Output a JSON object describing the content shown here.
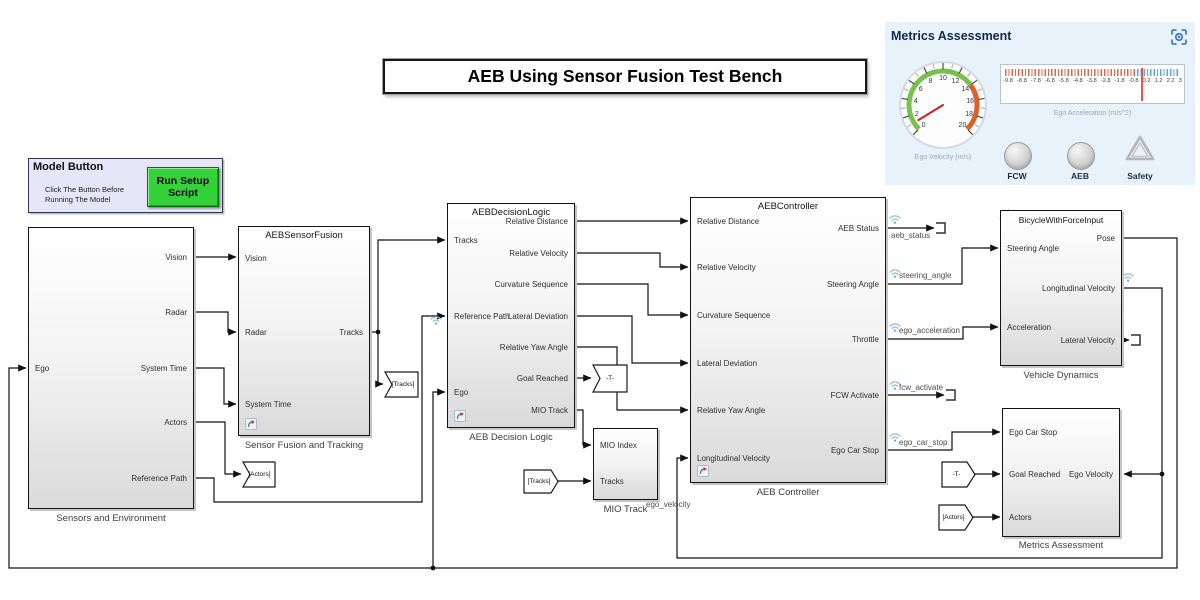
{
  "title": "AEB Using Sensor Fusion Test Bench",
  "model_button": {
    "title": "Model Button",
    "description_line1": "Click The Button Before",
    "description_line2": "Running The Model",
    "button_label": "Run Setup Script",
    "button_color": "#35d13a"
  },
  "metrics_panel": {
    "title": "Metrics Assessment",
    "expand_icon": "viewfinder-gear-icon",
    "velocity_gauge": {
      "label": "Ego Velocity (m/s)",
      "min": 0,
      "max": 20,
      "tick_labels": [
        "0",
        "2",
        "4",
        "6",
        "8",
        "10",
        "12",
        "14",
        "16",
        "18",
        "20"
      ],
      "green_range": [
        0,
        14
      ],
      "red_range": [
        14,
        20
      ],
      "needle_value": 1,
      "green_color": "#77c14d",
      "red_color": "#d9622c",
      "needle_color": "#cf201f"
    },
    "accel_gauge": {
      "label": "Ego Acceleration (m/s^2)",
      "tick_labels": [
        "-9.8",
        "-8.8",
        "-7.8",
        "-6.8",
        "-5.8",
        "-4.8",
        "-3.8",
        "-2.8",
        "-1.8",
        "-0.8",
        "0.2",
        "1.2",
        "2.2",
        "3"
      ],
      "needle_value": 0.2,
      "red_color": "#dd674d",
      "blue_color": "#56a8dd",
      "needle_color": "#f25050"
    },
    "lamps": [
      {
        "label": "FCW"
      },
      {
        "label": "AEB"
      }
    ],
    "safety": {
      "label": "Safety"
    }
  },
  "blocks": {
    "sensors_environment": {
      "caption": "Sensors and Environment",
      "inputs": [
        "Ego"
      ],
      "outputs": [
        "Vision",
        "Radar",
        "System Time",
        "Actors",
        "Reference Path"
      ]
    },
    "sensor_fusion": {
      "header": "AEBSensorFusion",
      "caption": "Sensor Fusion and Tracking",
      "inputs": [
        "Vision",
        "Radar",
        "System Time"
      ],
      "outputs": [
        "Tracks"
      ]
    },
    "decision_logic": {
      "header": "AEBDecisionLogic",
      "caption": "AEB Decision Logic",
      "inputs": [
        "Tracks",
        "Reference Path",
        "Ego"
      ],
      "outputs": [
        "Relative Distance",
        "Relative Velocity",
        "Curvature Sequence",
        "Lateral Deviation",
        "Relative Yaw Angle",
        "Goal Reached",
        "MIO Track"
      ]
    },
    "controller": {
      "header": "AEBController",
      "caption": "AEB Controller",
      "inputs": [
        "Relative Distance",
        "Relative Velocity",
        "Curvature Sequence",
        "Lateral Deviation",
        "Relative Yaw Angle",
        "Longitudinal Velocity"
      ],
      "outputs": [
        "AEB Status",
        "Steering Angle",
        "Throttle",
        "FCW Activate",
        "Ego Car Stop"
      ]
    },
    "vehicle_dynamics": {
      "header": "BicycleWithForceInput",
      "caption": "Vehicle Dynamics",
      "inputs": [
        "Steering Angle",
        "Acceleration"
      ],
      "outputs": [
        "Pose",
        "Longitudinal Velocity",
        "Lateral Velocity"
      ]
    },
    "metrics_assessment": {
      "caption": "Metrics Assessment",
      "inputs": [
        "Ego Car Stop",
        "Goal Reached",
        "Actors"
      ],
      "right_inputs": [
        "Ego Velocity"
      ]
    },
    "mio_track": {
      "caption": "MIO Track",
      "inputs": [
        "MIO Index",
        "Tracks"
      ]
    }
  },
  "tags": {
    "goto_actors": "[Actors]",
    "goto_tracks": "[Tracks]",
    "goto_t": "-T-",
    "from_tracks": "[Tracks]",
    "from_t": "-T-",
    "from_actors": "[Actors]"
  },
  "signal_labels": {
    "aeb_status": "aeb_status",
    "steering_angle": "steering_angle",
    "ego_acceleration": "ego_acceleration",
    "fcw_activate": "fcw_activate",
    "ego_car_stop": "ego_car_stop",
    "ego_velocity": "ego_velocity"
  }
}
